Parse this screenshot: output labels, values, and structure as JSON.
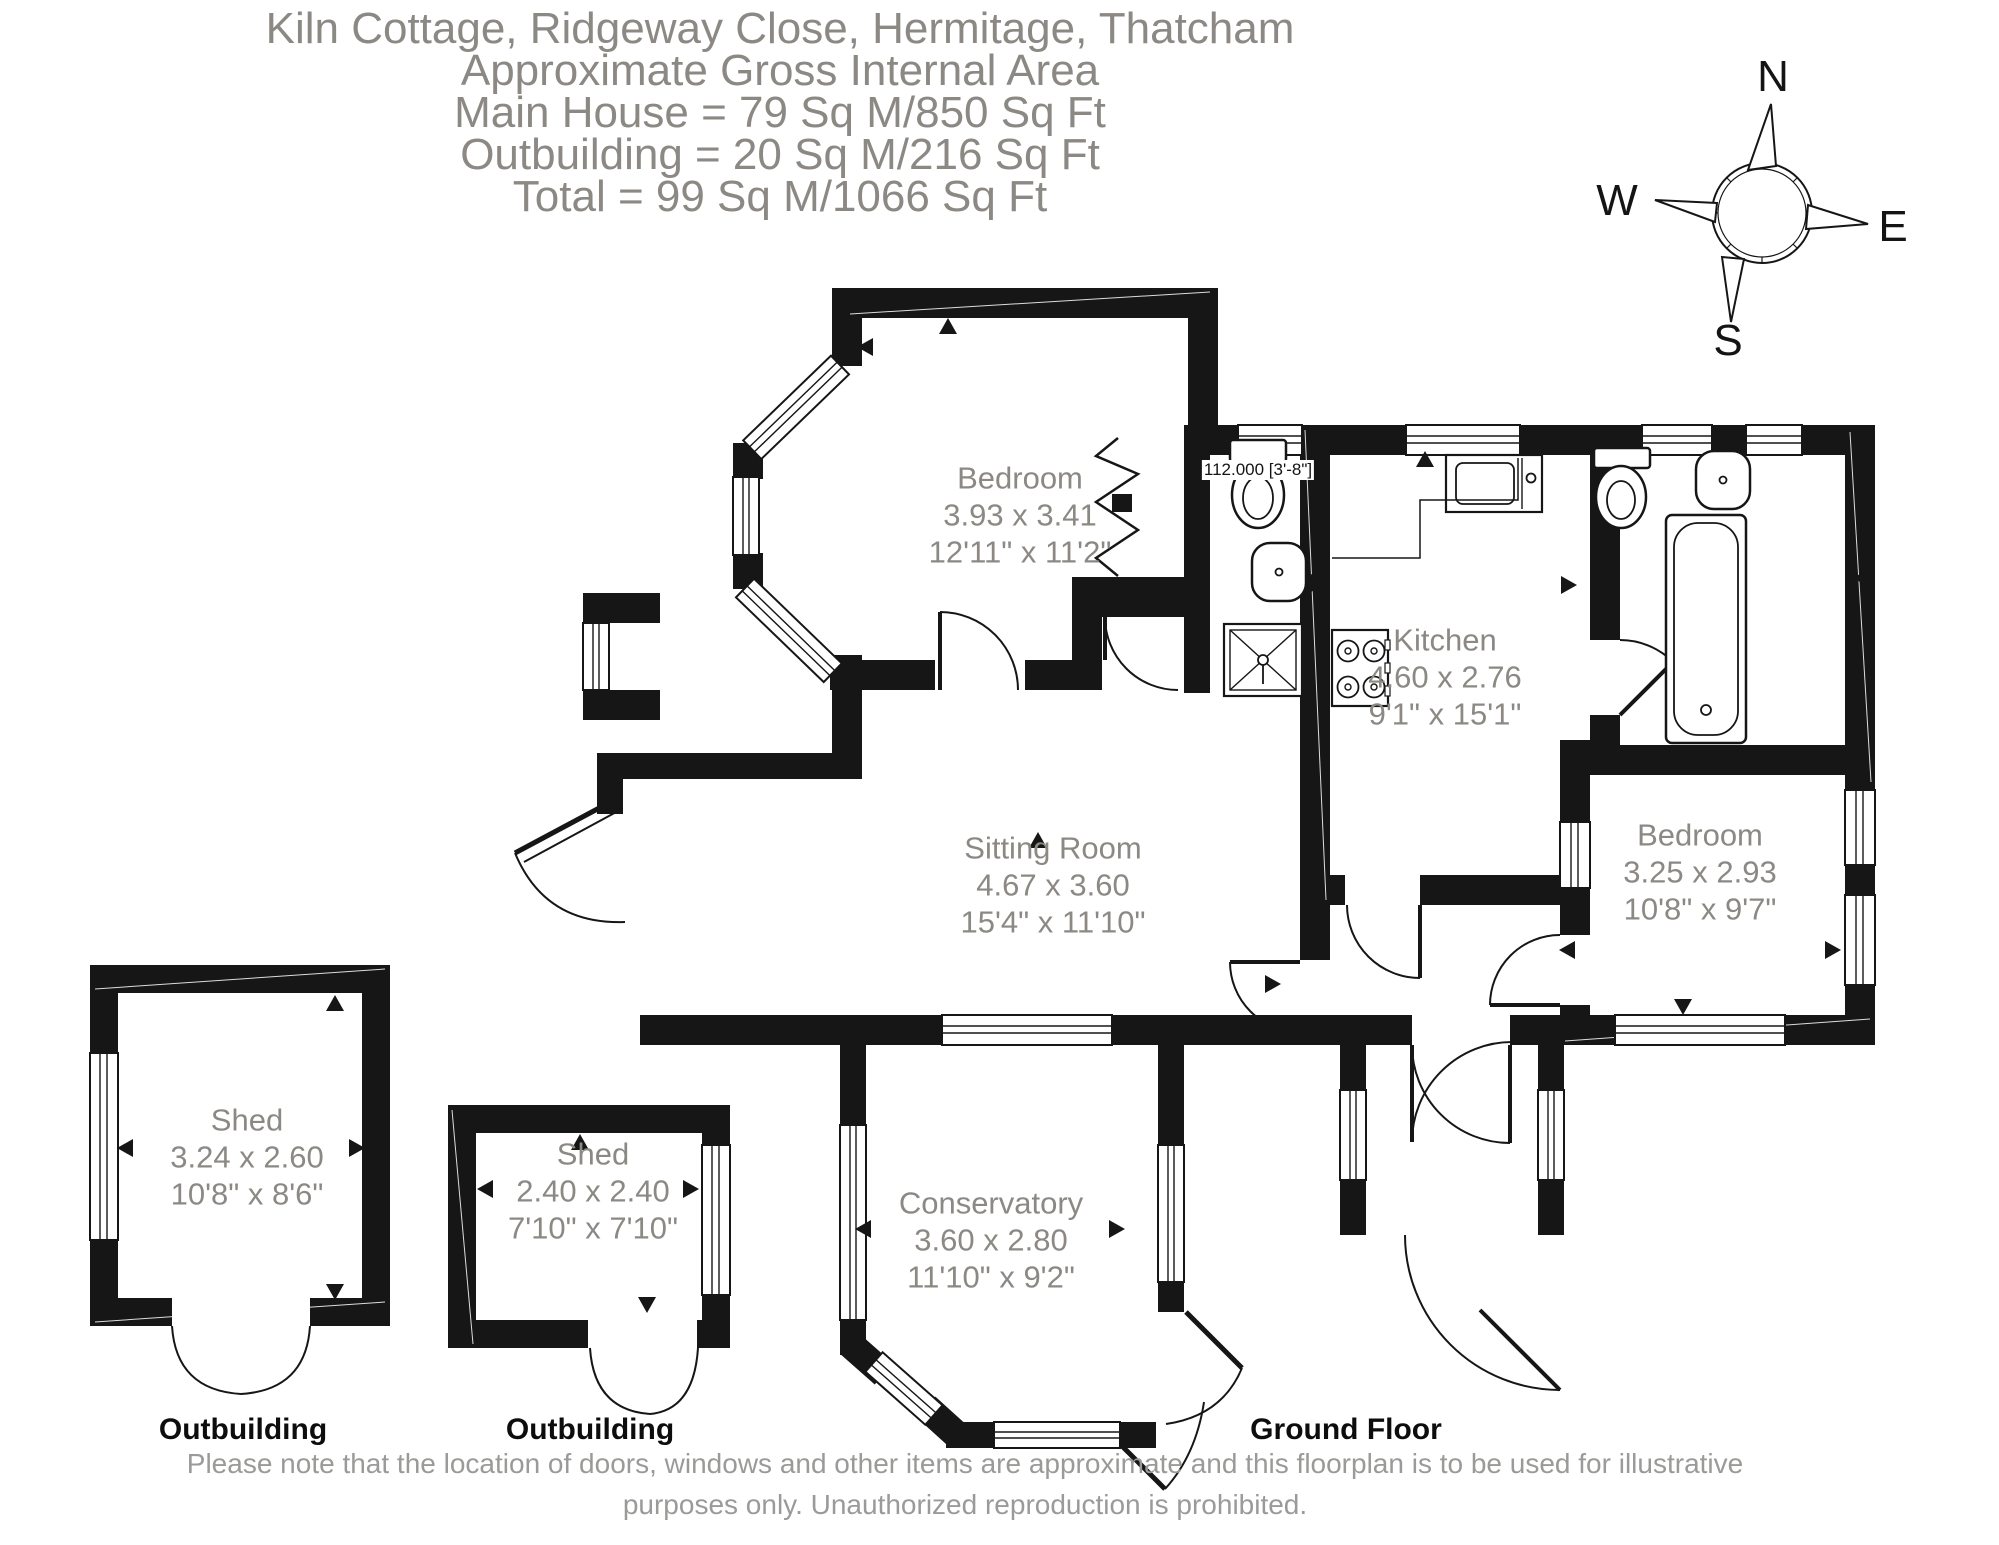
{
  "title": {
    "line1": "Kiln Cottage, Ridgeway Close, Hermitage, Thatcham",
    "line2": "Approximate Gross Internal Area",
    "line3": "Main House = 79 Sq M/850 Sq Ft",
    "line4": "Outbuilding = 20 Sq M/216 Sq Ft",
    "line5": "Total = 99 Sq M/1066 Sq Ft"
  },
  "compass": {
    "north": "N",
    "east": "E",
    "south": "S",
    "west": "W"
  },
  "rooms": [
    {
      "name": "Bedroom",
      "metric": "3.93 x 3.41",
      "imperial": "12'11\" x 11'2\""
    },
    {
      "name": "Kitchen",
      "metric": "4.60 x 2.76",
      "imperial": "9'1\" x 15'1\""
    },
    {
      "name": "Sitting Room",
      "metric": "4.67 x 3.60",
      "imperial": "15'4\" x 11'10\""
    },
    {
      "name": "Bedroom",
      "metric": "3.25 x 2.93",
      "imperial": "10'8\" x 9'7\""
    },
    {
      "name": "Conservatory",
      "metric": "3.60 x 2.80",
      "imperial": "11'10\" x 9'2\""
    },
    {
      "name": "Shed",
      "metric": "3.24 x 2.60",
      "imperial": "10'8\" x 8'6\""
    },
    {
      "name": "Shed",
      "metric": "2.40 x 2.40",
      "imperial": "7'10\" x 7'10\""
    }
  ],
  "annotations": {
    "wc_dimension": "112.000 [3'-8\"]",
    "outbuilding_1": "Outbuilding",
    "outbuilding_2": "Outbuilding",
    "floor_label": "Ground Floor"
  },
  "disclaimer": {
    "line1": "Please note that the location of doors, windows and other items are approximate and this floorplan is to be used for illustrative",
    "line2": "purposes only. Unauthorized reproduction is prohibited."
  },
  "colors": {
    "wall": "#161616",
    "label_gray": "#8c8984",
    "disclaimer_gray": "#9a9a98"
  }
}
